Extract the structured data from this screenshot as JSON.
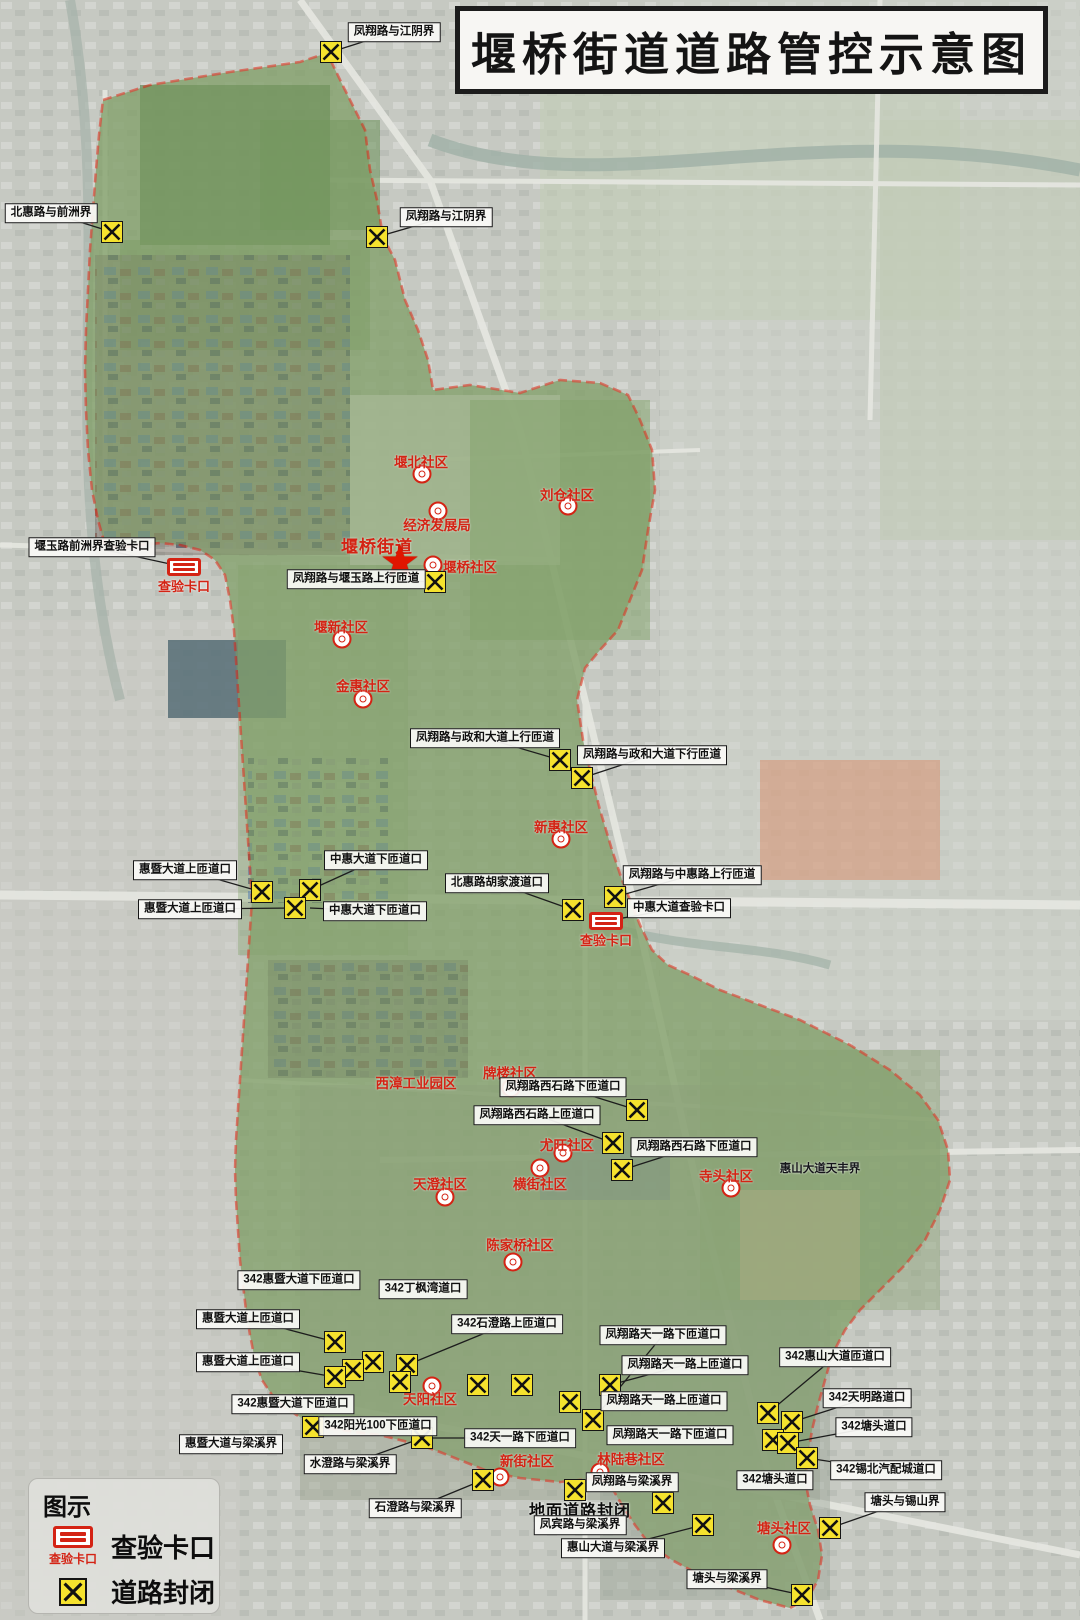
{
  "title": "堰桥街道道路管控示意图",
  "legend": {
    "header": "图示",
    "items": [
      {
        "icon": "checkpoint-icon",
        "caption": "查验卡口",
        "label": "查验卡口"
      },
      {
        "icon": "road-closure-icon",
        "caption": "",
        "label": "道路封闭"
      }
    ]
  },
  "colors": {
    "boundary_red": "#e02a18",
    "closure_yellow": "#f5e22e",
    "checkpoint_red": "#d42314",
    "community_red": "#d42314"
  },
  "map": {
    "street_office": {
      "label": "堰桥街道",
      "x": 377,
      "y": 545,
      "star_x": 400,
      "star_y": 562
    },
    "road_labels": [
      {
        "t": "凤翔路与江阴界",
        "x": 394,
        "y": 32,
        "lx": 331,
        "ly": 52
      },
      {
        "t": "北惠路与前洲界",
        "x": 51,
        "y": 213,
        "lx": 112,
        "ly": 232
      },
      {
        "t": "凤翔路与江阴界",
        "x": 446,
        "y": 217,
        "lx": 377,
        "ly": 237
      },
      {
        "t": "堰玉路前洲界查验卡口",
        "x": 92,
        "y": 547,
        "lx": 184,
        "ly": 567
      },
      {
        "t": "凤翔路与堰玉路上行匝道",
        "x": 356,
        "y": 579,
        "lx": 435,
        "ly": 582
      },
      {
        "t": "凤翔路与政和大道上行匝道",
        "x": 485,
        "y": 738,
        "lx": 560,
        "ly": 760
      },
      {
        "t": "凤翔路与政和大道下行匝道",
        "x": 652,
        "y": 755,
        "lx": 582,
        "ly": 778
      },
      {
        "t": "惠暨大道上匝道口",
        "x": 185,
        "y": 870,
        "lx": 262,
        "ly": 892
      },
      {
        "t": "中惠大道下匝道口",
        "x": 376,
        "y": 860,
        "lx": 310,
        "ly": 890
      },
      {
        "t": "惠暨大道上匝道口",
        "x": 190,
        "y": 909,
        "lx": 295,
        "ly": 908
      },
      {
        "t": "中惠大道下匝道口",
        "x": 375,
        "y": 911,
        "lx": 310,
        "ly": 908
      },
      {
        "t": "北惠路胡家渡道口",
        "x": 497,
        "y": 883,
        "lx": 573,
        "ly": 910
      },
      {
        "t": "凤翔路与中惠路上行匝道",
        "x": 692,
        "y": 875,
        "lx": 615,
        "ly": 897
      },
      {
        "t": "中惠大道查验卡口",
        "x": 679,
        "y": 908,
        "lx": 606,
        "ly": 921
      },
      {
        "t": "凤翔路西石路下匝道口",
        "x": 563,
        "y": 1087,
        "lx": 637,
        "ly": 1110
      },
      {
        "t": "凤翔路西石路上匝道口",
        "x": 537,
        "y": 1115,
        "lx": 613,
        "ly": 1143
      },
      {
        "t": "凤翔路西石路下匝道口",
        "x": 694,
        "y": 1147,
        "lx": 622,
        "ly": 1170
      },
      {
        "t": "342惠暨大道下匝道口",
        "x": 299,
        "y": 1280
      },
      {
        "t": "342丁枫湾道口",
        "x": 423,
        "y": 1289
      },
      {
        "t": "惠暨大道上匝道口",
        "x": 248,
        "y": 1319,
        "lx": 335,
        "ly": 1342
      },
      {
        "t": "342石澄路上匝道口",
        "x": 507,
        "y": 1324,
        "lx": 407,
        "ly": 1365
      },
      {
        "t": "凤翔路天一路下匝道口",
        "x": 663,
        "y": 1335,
        "lx": 593,
        "ly": 1420
      },
      {
        "t": "惠暨大道上匝道口",
        "x": 248,
        "y": 1362,
        "lx": 335,
        "ly": 1377
      },
      {
        "t": "凤翔路天一路上匝道口",
        "x": 685,
        "y": 1365,
        "lx": 610,
        "ly": 1385
      },
      {
        "t": "342惠山大道匝道口",
        "x": 835,
        "y": 1357,
        "lx": 768,
        "ly": 1413
      },
      {
        "t": "342惠暨大道下匝道口",
        "x": 293,
        "y": 1404
      },
      {
        "t": "凤翔路天一路上匝道口",
        "x": 664,
        "y": 1401
      },
      {
        "t": "342天明路道口",
        "x": 867,
        "y": 1398,
        "lx": 792,
        "ly": 1422
      },
      {
        "t": "342阳光100下匝道口",
        "x": 378,
        "y": 1426,
        "lx": 313,
        "ly": 1427
      },
      {
        "t": "342塘头道口",
        "x": 874,
        "y": 1427,
        "lx": 788,
        "ly": 1443
      },
      {
        "t": "凤翔路天一路下匝道口",
        "x": 670,
        "y": 1435
      },
      {
        "t": "342天一路下匝道口",
        "x": 520,
        "y": 1438,
        "lx": 422,
        "ly": 1438
      },
      {
        "t": "惠暨大道与梁溪界",
        "x": 231,
        "y": 1444
      },
      {
        "t": "水澄路与梁溪界",
        "x": 350,
        "y": 1464,
        "lx": 422,
        "ly": 1438
      },
      {
        "t": "342锡北汽配城道口",
        "x": 886,
        "y": 1470,
        "lx": 807,
        "ly": 1458
      },
      {
        "t": "342塘头道口",
        "x": 775,
        "y": 1480
      },
      {
        "t": "凤翔路与梁溪界",
        "x": 632,
        "y": 1482
      },
      {
        "t": "塘头与锡山界",
        "x": 905,
        "y": 1502,
        "lx": 830,
        "ly": 1528
      },
      {
        "t": "石澄路与梁溪界",
        "x": 415,
        "y": 1508,
        "lx": 483,
        "ly": 1480
      },
      {
        "t": "凤宾路与梁溪界",
        "x": 580,
        "y": 1525
      },
      {
        "t": "惠山大道与梁溪界",
        "x": 613,
        "y": 1548,
        "lx": 703,
        "ly": 1525
      },
      {
        "t": "塘头与梁溪界",
        "x": 727,
        "y": 1579,
        "lx": 802,
        "ly": 1595
      }
    ],
    "plain_labels": [
      {
        "t": "惠山大道天丰界",
        "x": 820,
        "y": 1168,
        "big": false
      },
      {
        "t": "地面道路封闭",
        "x": 580,
        "y": 1509,
        "big": true
      }
    ],
    "communities": [
      {
        "t": "堰北社区",
        "x": 421,
        "y": 461,
        "cx": 422,
        "cy": 474
      },
      {
        "t": "刘仓社区",
        "x": 567,
        "y": 494,
        "cx": 568,
        "cy": 506
      },
      {
        "t": "经济发展局",
        "x": 437,
        "y": 524,
        "cx": 438,
        "cy": 511
      },
      {
        "t": "堰桥社区",
        "x": 470,
        "y": 566,
        "cx": 433,
        "cy": 565
      },
      {
        "t": "堰新社区",
        "x": 341,
        "y": 626,
        "cx": 342,
        "cy": 639
      },
      {
        "t": "金惠社区",
        "x": 363,
        "y": 685,
        "cx": 363,
        "cy": 699
      },
      {
        "t": "新惠社区",
        "x": 561,
        "y": 826,
        "cx": 561,
        "cy": 839
      },
      {
        "t": "西漳工业园区",
        "x": 416,
        "y": 1082
      },
      {
        "t": "牌楼社区",
        "x": 510,
        "y": 1072,
        "cx": 511,
        "cy": 1088
      },
      {
        "t": "尤旺社区",
        "x": 567,
        "y": 1144,
        "cx": 563,
        "cy": 1153
      },
      {
        "t": "横街社区",
        "x": 540,
        "y": 1183,
        "cx": 540,
        "cy": 1168
      },
      {
        "t": "天澄社区",
        "x": 440,
        "y": 1183,
        "cx": 445,
        "cy": 1197
      },
      {
        "t": "寺头社区",
        "x": 726,
        "y": 1175,
        "cx": 731,
        "cy": 1188
      },
      {
        "t": "陈家桥社区",
        "x": 520,
        "y": 1244,
        "cx": 513,
        "cy": 1262
      },
      {
        "t": "天阳社区",
        "x": 430,
        "y": 1398,
        "cx": 432,
        "cy": 1386
      },
      {
        "t": "新街社区",
        "x": 527,
        "y": 1460,
        "cx": 500,
        "cy": 1477
      },
      {
        "t": "林陆巷社区",
        "x": 631,
        "y": 1458,
        "cx": 600,
        "cy": 1472
      },
      {
        "t": "塘头社区",
        "x": 784,
        "y": 1527,
        "cx": 782,
        "cy": 1545
      }
    ],
    "closures": [
      [
        331,
        52
      ],
      [
        112,
        232
      ],
      [
        377,
        237
      ],
      [
        435,
        582
      ],
      [
        560,
        760
      ],
      [
        582,
        778
      ],
      [
        262,
        892
      ],
      [
        310,
        890
      ],
      [
        295,
        908
      ],
      [
        573,
        910
      ],
      [
        615,
        897
      ],
      [
        637,
        1110
      ],
      [
        613,
        1143
      ],
      [
        622,
        1170
      ],
      [
        335,
        1342
      ],
      [
        373,
        1362
      ],
      [
        353,
        1370
      ],
      [
        335,
        1377
      ],
      [
        407,
        1365
      ],
      [
        400,
        1382
      ],
      [
        313,
        1427
      ],
      [
        422,
        1438
      ],
      [
        478,
        1385
      ],
      [
        522,
        1385
      ],
      [
        570,
        1402
      ],
      [
        593,
        1420
      ],
      [
        610,
        1385
      ],
      [
        483,
        1480
      ],
      [
        575,
        1490
      ],
      [
        768,
        1413
      ],
      [
        792,
        1422
      ],
      [
        773,
        1440
      ],
      [
        788,
        1443
      ],
      [
        807,
        1458
      ],
      [
        663,
        1503
      ],
      [
        703,
        1525
      ],
      [
        830,
        1528
      ],
      [
        802,
        1595
      ]
    ],
    "checkpoints": [
      {
        "x": 184,
        "y": 567,
        "caption": "查验卡口"
      },
      {
        "x": 606,
        "y": 921,
        "caption": "查验卡口"
      }
    ]
  }
}
